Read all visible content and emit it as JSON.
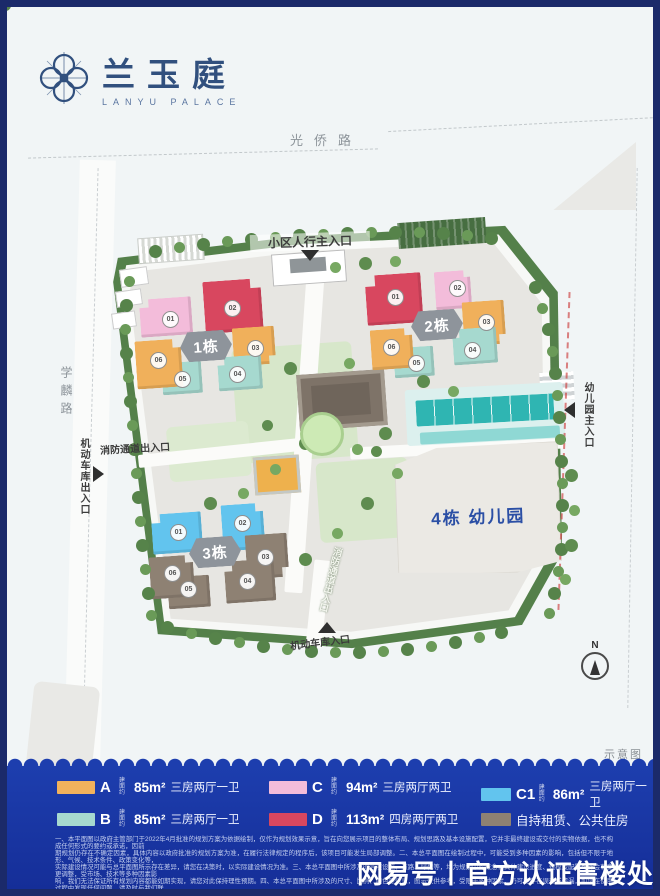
{
  "logo": {
    "name_cn": "兰玉庭",
    "name_en": "LANYU PALACE"
  },
  "roads": {
    "top": "光侨路",
    "left": "学麟路"
  },
  "map": {
    "entrances": {
      "main_pedestrian": "小区人行主入口",
      "fire_left": "消防通道出入口",
      "garage_left": "机动车库出入口",
      "kindergarten": "幼儿园主入口",
      "fire_bottom": "消防通道出入口",
      "garage_bottom": "机动车库入口"
    },
    "clusters": [
      {
        "name": "1栋",
        "units": [
          "01",
          "02",
          "03",
          "04",
          "05",
          "06"
        ]
      },
      {
        "name": "2栋",
        "units": [
          "01",
          "02",
          "03",
          "04",
          "05",
          "06"
        ]
      },
      {
        "name": "3栋",
        "units": [
          "01",
          "02",
          "03",
          "04",
          "05",
          "06"
        ]
      }
    ],
    "kindergarten_label": "4栋 幼儿园",
    "compass_label": "N",
    "caption": "示意图"
  },
  "legend": {
    "items": [
      {
        "code": "A",
        "prefix": "建面约",
        "area": "85m²",
        "desc": "三房两厅一卫",
        "color": "#f2b25c"
      },
      {
        "code": "B",
        "prefix": "建面约",
        "area": "85m²",
        "desc": "三房两厅一卫",
        "color": "#a6d9cf"
      },
      {
        "code": "C",
        "prefix": "建面约",
        "area": "94m²",
        "desc": "三房两厅两卫",
        "color": "#f3bcda"
      },
      {
        "code": "D",
        "prefix": "建面约",
        "area": "113m²",
        "desc": "四房两厅两卫",
        "color": "#d8475f"
      },
      {
        "code": "C1",
        "prefix": "建面约",
        "area": "86m²",
        "desc": "三房两厅一卫",
        "color": "#62c4ee"
      },
      {
        "code": "",
        "prefix": "",
        "area": "",
        "desc": "自持租赁、公共住房",
        "color": "#8e8173"
      }
    ]
  },
  "disclaimer": {
    "lines": [
      "一、本平面图以政府主管部门于2022年4月批准的规划方案为依据绘制，仅作为规划效果示意，旨在向您展示项目的整体布局、规划思路及基本设施配置，它并非最终建设或交付的实物依据，也不构成任何形式的要约或承诺，因前",
      "期规划仍存在不确定因素，具体内容以政府批准的规划方案为准，在履行法律规定的程序后，该项目可能发生局部调整。二、本总平面图在绘制过程中，可能受到多种因素的影响，包括但不限于地形、气候、技术条件、政策变化等，",
      "实际建设情况可能与总平面图所示存在差异，请您在决策时，以实际建设情况为准。三、本总平面图中所涉及的各项设施、道路、绿化等，均为规划中的概念，具体建设进度、规模及配置可能会有变更调整，受市场、技术等多种因素影",
      "响，我们无法保证所有规划内容都能如期实现，请您对此保持理性预期。四、本总平面图中所涉及的尺寸、比例、颜色等信息，图示仅供参考，受限于多种因素，仍可能存在误差或遗漏，如您在使用过程中发现任何问题，请及时与我们联",
      "系，建议您在参考时，结合实际情况进行判断。五、我们已尽力确保本总平面图的准确性，但仍可能存在误差，请您在参考时，结合实际情况进行判断。六、请您在查看或使用任何资料时，务必以专项合同、政府批准文件及实际建设情",
      "况为准，谨慎理性决策，我们不对因您依赖本总平面图而产生的任何损失承担责任。七、本公司保留对宣传资料修改的权利。"
    ]
  },
  "watermark": "网易号丨官方认证售楼处",
  "colors": {
    "panel": "#1d3eae",
    "frame": "#1b2a6a",
    "site_green": "#54804a",
    "ground": "#e7e6e2",
    "accent_blue": "#2b4fa5"
  }
}
